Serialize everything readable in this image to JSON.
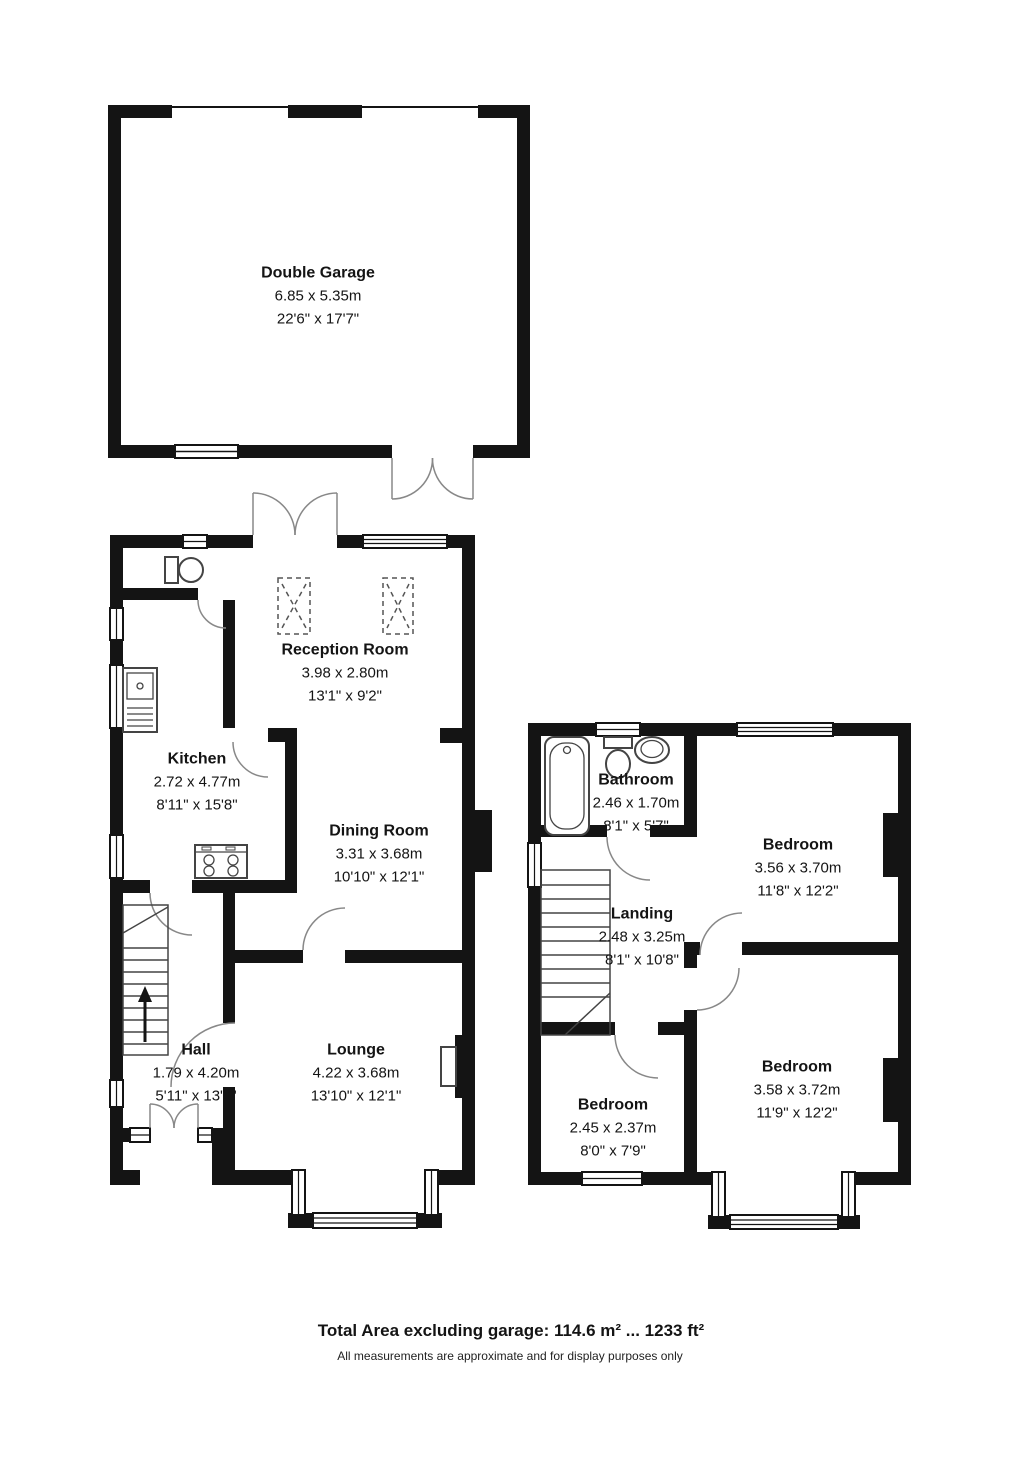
{
  "rooms": [
    {
      "id": "double-garage",
      "name": "Double Garage",
      "metric": "6.85 x 5.35m",
      "imperial": "22'6\" x 17'7\""
    },
    {
      "id": "reception-room",
      "name": "Reception Room",
      "metric": "3.98 x 2.80m",
      "imperial": "13'1\" x 9'2\""
    },
    {
      "id": "kitchen",
      "name": "Kitchen",
      "metric": "2.72 x 4.77m",
      "imperial": "8'11\" x 15'8\""
    },
    {
      "id": "dining-room",
      "name": "Dining Room",
      "metric": "3.31 x 3.68m",
      "imperial": "10'10\" x 12'1\""
    },
    {
      "id": "hall",
      "name": "Hall",
      "metric": "1.79 x 4.20m",
      "imperial": "5'11\" x 13'9\""
    },
    {
      "id": "lounge",
      "name": "Lounge",
      "metric": "4.22 x 3.68m",
      "imperial": "13'10\" x 12'1\""
    },
    {
      "id": "bathroom",
      "name": "Bathroom",
      "metric": "2.46 x 1.70m",
      "imperial": "8'1\" x 5'7\""
    },
    {
      "id": "bedroom-1",
      "name": "Bedroom",
      "metric": "3.56 x 3.70m",
      "imperial": "11'8\" x 12'2\""
    },
    {
      "id": "landing",
      "name": "Landing",
      "metric": "2.48 x 3.25m",
      "imperial": "8'1\" x 10'8\""
    },
    {
      "id": "bedroom-2",
      "name": "Bedroom",
      "metric": "3.58 x 3.72m",
      "imperial": "11'9\" x 12'2\""
    },
    {
      "id": "bedroom-3",
      "name": "Bedroom",
      "metric": "2.45 x 2.37m",
      "imperial": "8'0\" x 7'9\""
    }
  ],
  "footer": {
    "total": "Total Area excluding garage: 114.6 m² ... 1233 ft²",
    "disclaimer": "All measurements are approximate and for display purposes only"
  },
  "colors": {
    "wall": "#141414",
    "arc": "#888888",
    "fixture": "#444444"
  }
}
